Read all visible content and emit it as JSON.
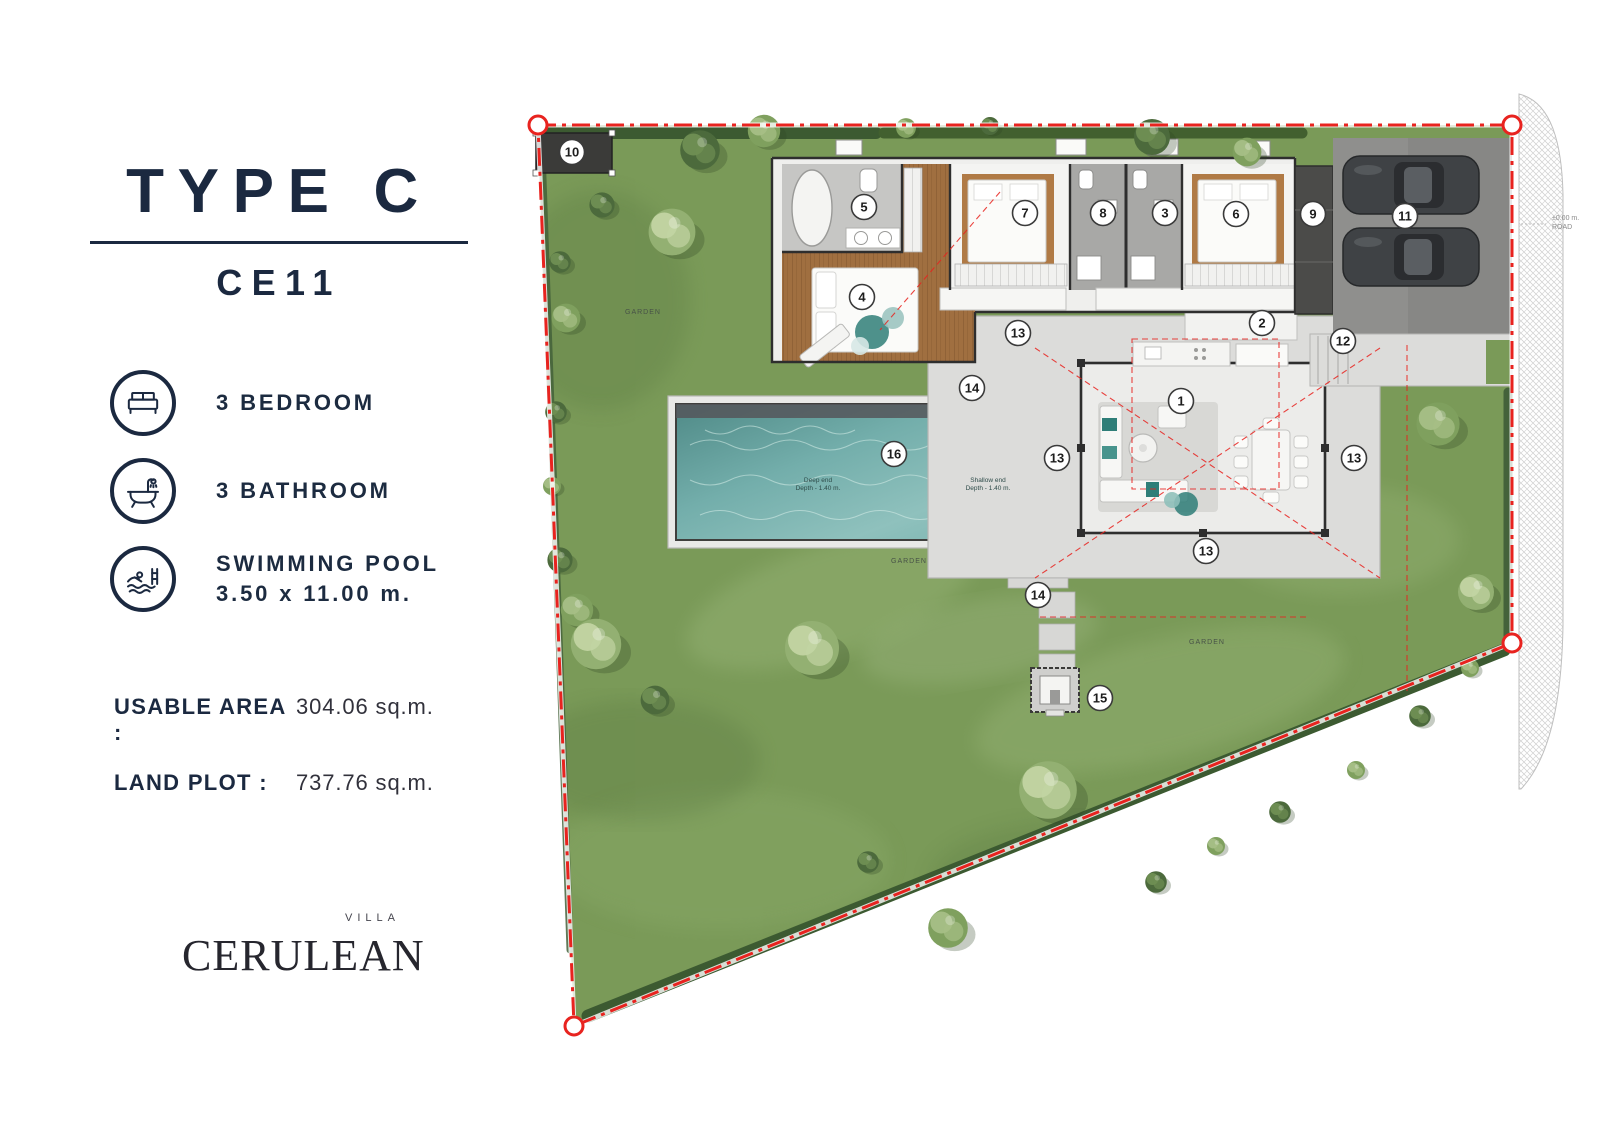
{
  "panel": {
    "title": "TYPE C",
    "code": "CE11",
    "features": [
      {
        "icon": "bed-icon",
        "label": "3 BEDROOM"
      },
      {
        "icon": "bathtub-icon",
        "label": "3 BATHROOM"
      },
      {
        "icon": "swimmer-icon",
        "label": "SWIMMING POOL",
        "sublabel": "3.50 x 11.00 m."
      }
    ],
    "areas": [
      {
        "label": "USABLE AREA :",
        "value": "304.06 sq.m."
      },
      {
        "label": "LAND PLOT :",
        "value": "737.76 sq.m."
      }
    ],
    "logo": {
      "name": "CERULEAN",
      "tagline": "VILLA"
    }
  },
  "plan": {
    "markers": [
      {
        "n": "1",
        "x": 1181,
        "y": 401
      },
      {
        "n": "2",
        "x": 1262,
        "y": 323
      },
      {
        "n": "3",
        "x": 1165,
        "y": 213
      },
      {
        "n": "4",
        "x": 862,
        "y": 297
      },
      {
        "n": "5",
        "x": 864,
        "y": 207
      },
      {
        "n": "6",
        "x": 1236,
        "y": 214
      },
      {
        "n": "7",
        "x": 1025,
        "y": 213
      },
      {
        "n": "8",
        "x": 1103,
        "y": 213
      },
      {
        "n": "9",
        "x": 1313,
        "y": 214
      },
      {
        "n": "10",
        "x": 572,
        "y": 152
      },
      {
        "n": "11",
        "x": 1405,
        "y": 216
      },
      {
        "n": "12",
        "x": 1343,
        "y": 341
      },
      {
        "n": "13",
        "x": 1018,
        "y": 333
      },
      {
        "n": "13",
        "x": 1057,
        "y": 458
      },
      {
        "n": "13",
        "x": 1354,
        "y": 458
      },
      {
        "n": "13",
        "x": 1206,
        "y": 551
      },
      {
        "n": "14",
        "x": 972,
        "y": 388
      },
      {
        "n": "14",
        "x": 1038,
        "y": 595
      },
      {
        "n": "15",
        "x": 1100,
        "y": 698
      },
      {
        "n": "16",
        "x": 894,
        "y": 454
      }
    ],
    "garden_labels": [
      {
        "text": "GARDEN",
        "x": 643,
        "y": 314
      },
      {
        "text": "GARDEN",
        "x": 909,
        "y": 563
      },
      {
        "text": "GARDEN",
        "x": 1207,
        "y": 644
      }
    ],
    "pool_labels": [
      {
        "lines": [
          "Deep end",
          "Depth - 1.40 m."
        ],
        "x": 818,
        "y": 482
      },
      {
        "lines": [
          "Shallow end",
          "Depth - 1.40 m."
        ],
        "x": 988,
        "y": 482
      }
    ],
    "road_label": {
      "lines": [
        "±0.00 m.",
        "ROAD"
      ],
      "x": 1552,
      "y": 220
    }
  },
  "colors": {
    "accent_navy": "#1b2940",
    "boundary_red": "#e8231f",
    "lawn_green": "#79995a",
    "pool_teal": "#6fb0ab",
    "wood_floor": "#a06f40"
  }
}
